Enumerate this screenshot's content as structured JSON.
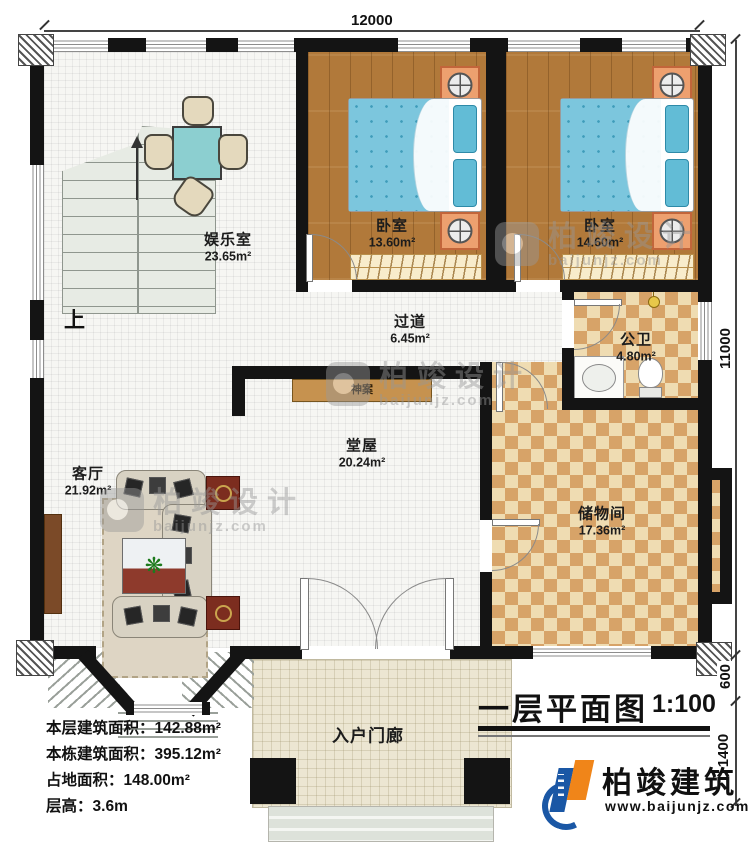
{
  "title": {
    "text": "一层平面图",
    "scale": "1:100"
  },
  "dimensions": {
    "top_width": "12000",
    "right_height": "11000",
    "right_lower_a": "600",
    "right_lower_b": "1400"
  },
  "rooms": [
    {
      "name": "娱乐室",
      "area": "23.65m²"
    },
    {
      "name": "卧室",
      "area": "13.60m²"
    },
    {
      "name": "卧室",
      "area": "14.60m²"
    },
    {
      "name": "公卫",
      "area": "4.80m²"
    },
    {
      "name": "过道",
      "area": "6.45m²"
    },
    {
      "name": "客厅",
      "area": "21.92m²"
    },
    {
      "name": "堂屋",
      "area": "20.24m²"
    },
    {
      "name": "储物间",
      "area": "17.36m²"
    },
    {
      "name": "入户门廊"
    }
  ],
  "annotations": {
    "stairs_up": "上",
    "altar": "神案"
  },
  "info_lines": [
    {
      "label": "本层建筑面积：",
      "value": "142.88m²"
    },
    {
      "label": "本栋建筑面积：",
      "value": "395.12m²"
    },
    {
      "label": "占地面积：",
      "value": "148.00m²"
    },
    {
      "label": "层高：",
      "value": "3.6m"
    }
  ],
  "branding": {
    "company": "柏竣建筑",
    "website": "www.baijunjz.com"
  },
  "watermark": {
    "text": "柏竣设计",
    "site": "baijunjz.com"
  },
  "icons": {
    "plant": "❋"
  },
  "colors": {
    "wall": "#141414",
    "wood_floor": "#b1793a",
    "checker_dark": "#d7a368",
    "checker_light": "#efdcb2",
    "bed_blue": "#7cc6dd",
    "logo_blue": "#1a57a5",
    "logo_orange": "#f08519"
  }
}
